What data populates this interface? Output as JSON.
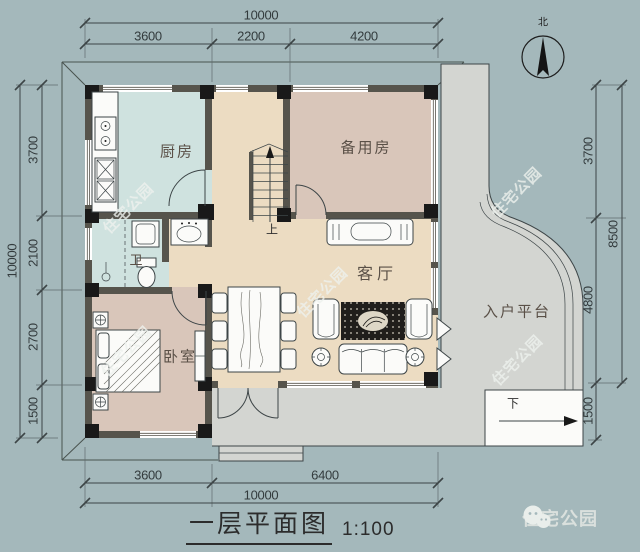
{
  "page": {
    "title_text": "一层平面图",
    "scale_label": "1:100"
  },
  "compass": {
    "north_label": "北"
  },
  "rooms": {
    "kitchen": "厨房",
    "spare_room": "备用房",
    "bathroom": "卫",
    "bedroom": "卧室",
    "living_room": "客厅",
    "entry_platform": "入户平台"
  },
  "stairs": {
    "up_label": "上",
    "down_label": "下"
  },
  "dimensions": {
    "top": {
      "total": "10000",
      "segments": [
        "3600",
        "2200",
        "4200"
      ]
    },
    "bottom": {
      "total": "10000",
      "segments": [
        "3600",
        "6400"
      ]
    },
    "left": {
      "total": "10000",
      "segments": [
        "3700",
        "2100",
        "2700",
        "1500"
      ]
    },
    "right": {
      "outer_total": "8500",
      "segments": [
        "3700",
        "4800",
        "1500"
      ]
    }
  },
  "watermark": {
    "text": "住宅公园"
  },
  "footer": {
    "brand": "住宅公园"
  },
  "colors": {
    "bg": "#a4b8bb",
    "platform": "#d3d5d1",
    "wall": "#56544c",
    "column": "#191919",
    "floor_wet": "#cfe2df",
    "floor_main": "#ecdcc2",
    "floor_bed": "#d9c6ba",
    "line": "#3d4547",
    "ink": "#333b3d",
    "room_ink": "#5a5047",
    "watermark": "rgba(238,241,238,0.8)",
    "footer_ink": "#dae0dd",
    "fixture": "#fbfbf9",
    "rug": "#201e1b"
  }
}
